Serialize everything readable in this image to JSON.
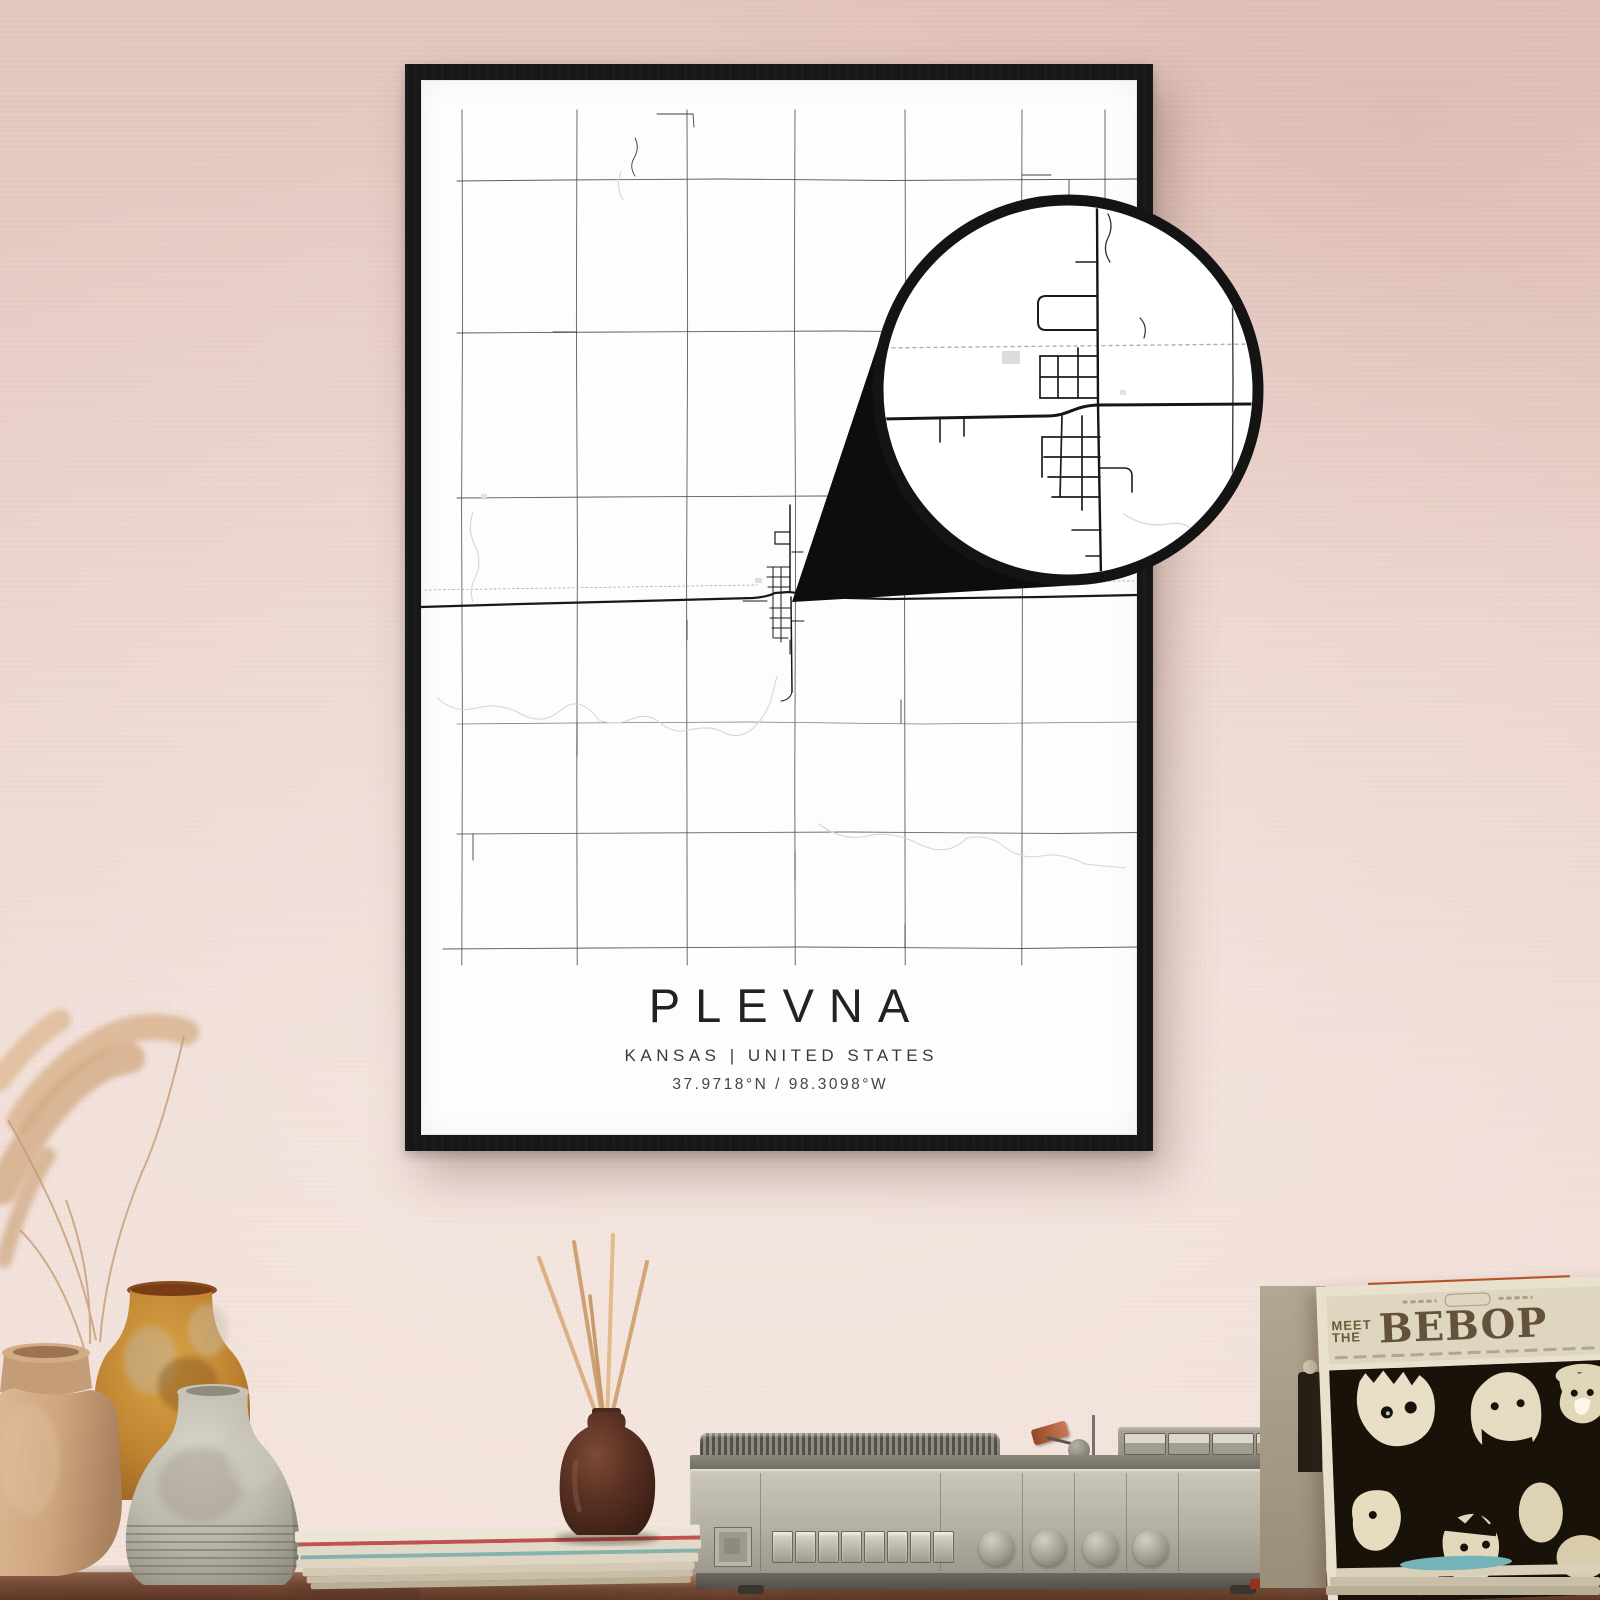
{
  "poster": {
    "title": "PLEVNA",
    "subtitle": "KANSAS | UNITED STATES",
    "coords": "37.9718°N / 98.3098°W"
  },
  "record_sleeve": {
    "meet": "MEET",
    "the": "THE",
    "album": "BEBOP"
  },
  "colors": {
    "wall_top": "#e3c6be",
    "wall_bottom": "#f3e2db",
    "frame": "#171717",
    "poster_paper": "#fdfdfc",
    "map_road": "#3f3f3f",
    "map_highway": "#181818",
    "map_water": "#d6d6d6",
    "railroad": "#a8a8a8",
    "callout_black": "#0d0d0d",
    "shelf_wood": "#7d4e37",
    "player_body": "#b4b0a4",
    "sleeve_cream": "#ded6c0",
    "sleeve_art_dark": "#191209",
    "accent_orange": "#bf5527",
    "accent_teal": "#74b3b8",
    "vase_tan": "#cda57f",
    "vase_ochre": "#c08431",
    "vase_gray": "#bcb8ab"
  }
}
